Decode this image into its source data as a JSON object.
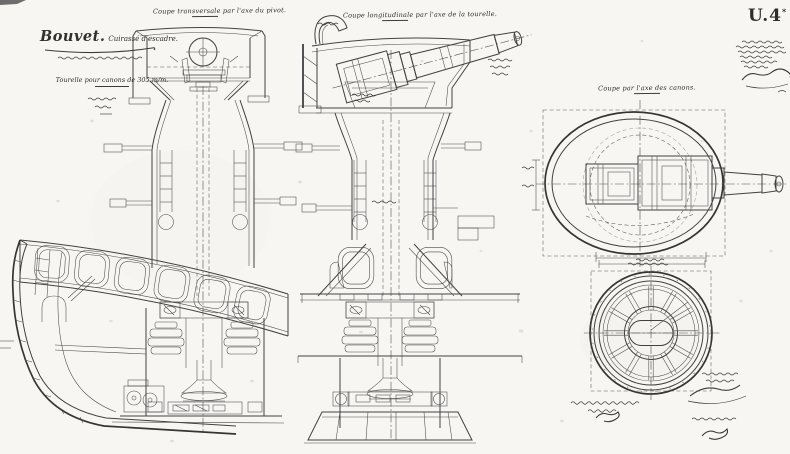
{
  "sheet": {
    "mark": "U.4",
    "mark_sup": "*"
  },
  "title_block": {
    "ship_name": "Bouvet.",
    "ship_type": "Cuirassé d'escadre.",
    "subtitle": "Tourelle pour canons de 305 m/m."
  },
  "captions": {
    "view1": "Coupe transversale par l'axe du pivot.",
    "view2": "Coupe longitudinale par l'axe de la tourelle.",
    "view3": "Coupe par l'axe des canons."
  },
  "colors": {
    "paper": "#f7f6f2",
    "ink": "#414141"
  }
}
